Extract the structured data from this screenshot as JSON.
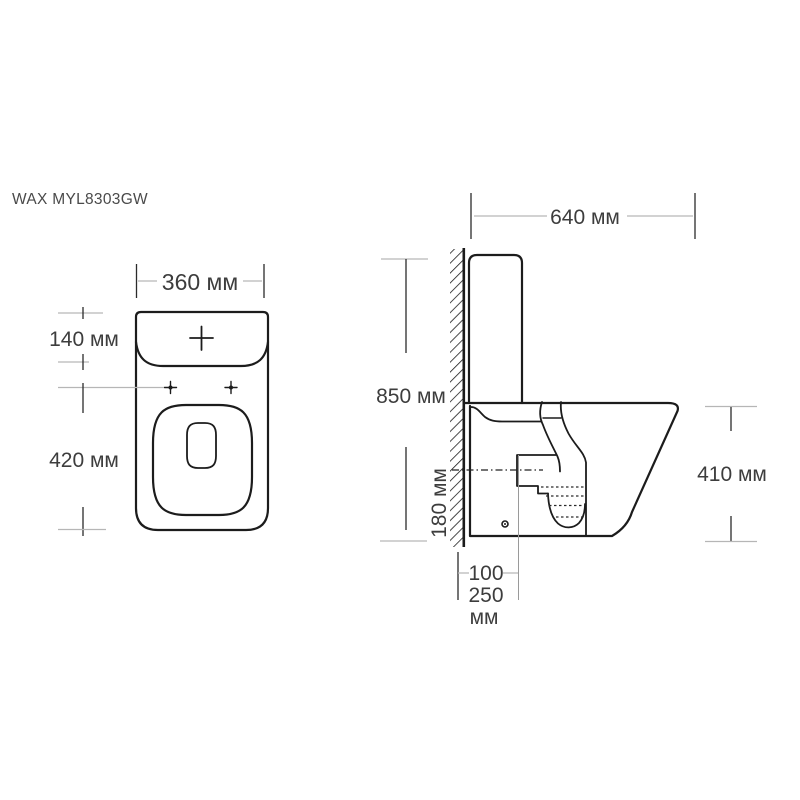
{
  "page": {
    "background": "#ffffff"
  },
  "drawing": {
    "model": "WAX MYL8303GW",
    "unit": "мм",
    "views": {
      "top": {
        "name": "top-view",
        "dims": {
          "width": "360 мм",
          "tank_depth": "140 мм",
          "bowl_length": "420 мм"
        }
      },
      "side": {
        "name": "side-view",
        "dims": {
          "depth": "640 мм",
          "height": "850 мм",
          "outlet_height": "180 мм",
          "rim_height": "410 мм",
          "outlet_offset_min": "100",
          "outlet_offset_max": "250",
          "outlet_offset_unit": "мм"
        }
      }
    }
  },
  "colors": {
    "outline": "#1c1c1c",
    "dimension_line": "#b6b6b6",
    "text": "#3d3d3d",
    "background": "#ffffff"
  }
}
